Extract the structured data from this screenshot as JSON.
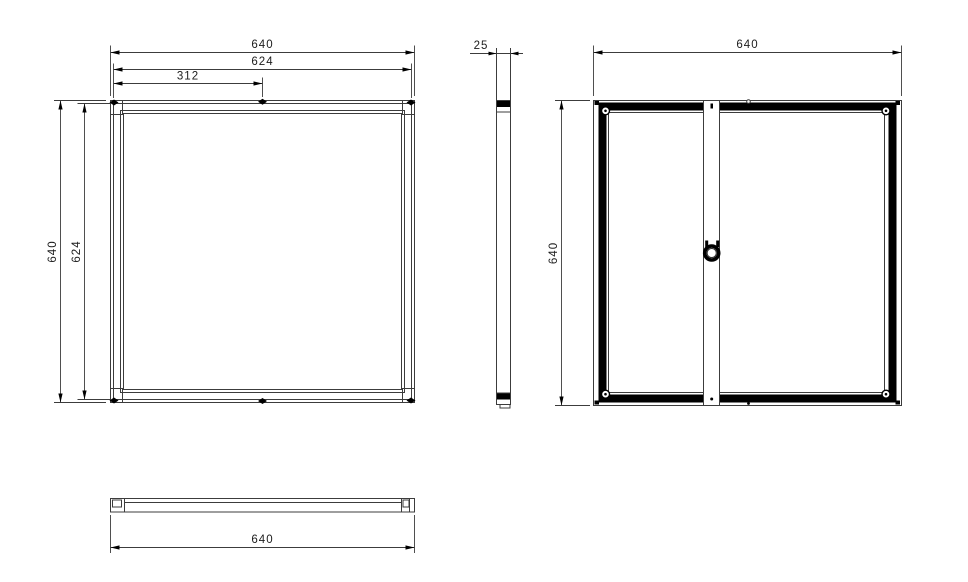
{
  "colors": {
    "background": "#ffffff",
    "line": "#3c3c3c",
    "heavy": "#000000",
    "text": "#1c1c1c"
  },
  "dimensions": {
    "front": {
      "width_outer": "640",
      "width_inner": "624",
      "width_half": "312",
      "height_outer": "640",
      "height_inner": "624"
    },
    "side": {
      "depth": "25"
    },
    "rear": {
      "width": "640",
      "height": "640"
    },
    "bottom": {
      "length": "640"
    }
  }
}
